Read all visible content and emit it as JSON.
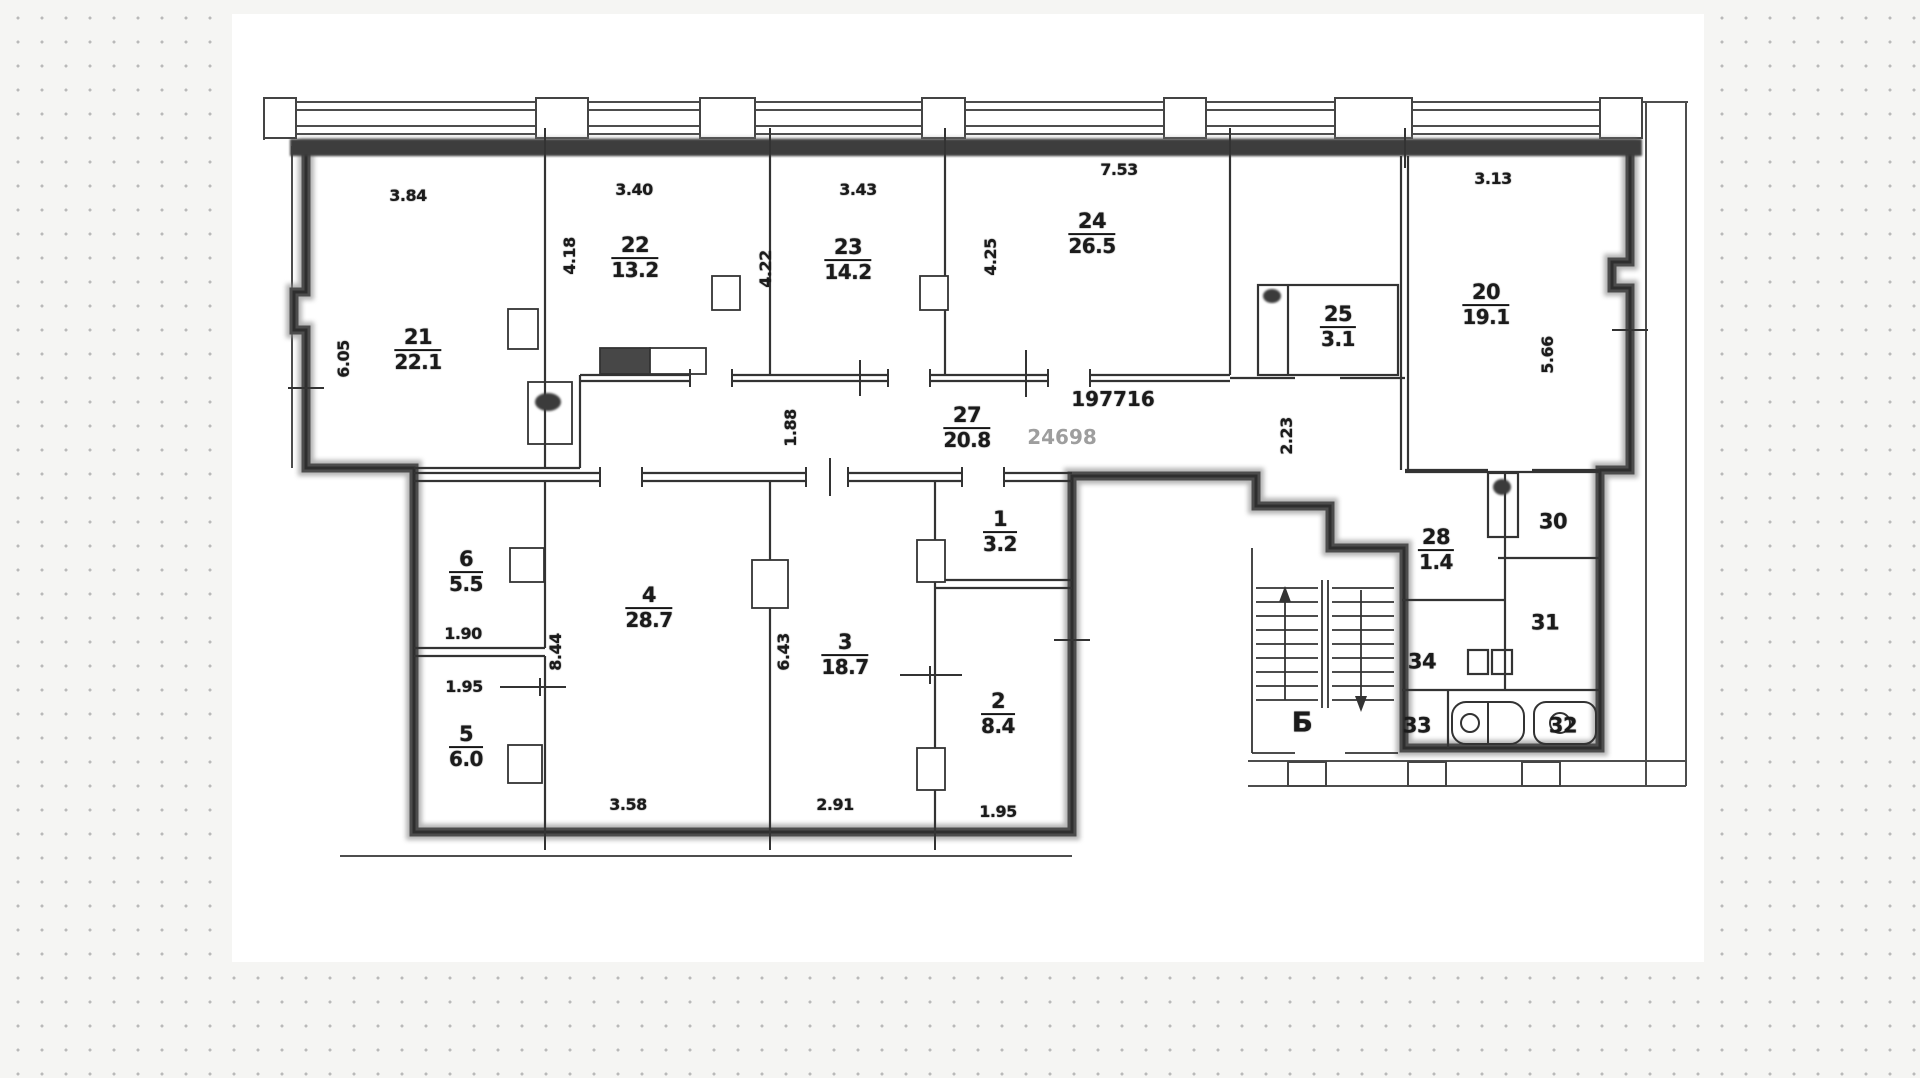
{
  "plan": {
    "stamp_black": "197716",
    "stamp_gray": "24698",
    "stair_label": "Б",
    "rooms": {
      "r21": {
        "n": "21",
        "a": "22.1"
      },
      "r22": {
        "n": "22",
        "a": "13.2"
      },
      "r23": {
        "n": "23",
        "a": "14.2"
      },
      "r24": {
        "n": "24",
        "a": "26.5"
      },
      "r25": {
        "n": "25",
        "a": "3.1"
      },
      "r20": {
        "n": "20",
        "a": "19.1"
      },
      "r27": {
        "n": "27",
        "a": "20.8"
      },
      "r1": {
        "n": "1",
        "a": "3.2"
      },
      "r2": {
        "n": "2",
        "a": "8.4"
      },
      "r3": {
        "n": "3",
        "a": "18.7"
      },
      "r4": {
        "n": "4",
        "a": "28.7"
      },
      "r5": {
        "n": "5",
        "a": "6.0"
      },
      "r6": {
        "n": "6",
        "a": "5.5"
      },
      "r28": {
        "n": "28",
        "a": "1.4"
      }
    },
    "numbers_only": {
      "r30": "30",
      "r31": "31",
      "r34": "34",
      "r33": "33",
      "r32": "32"
    },
    "dims": {
      "w21": "3.84",
      "w22": "3.40",
      "w23": "3.43",
      "w24": "7.53",
      "w20": "3.13",
      "h21": "6.05",
      "h22": "4.18",
      "h23": "4.22",
      "h24": "4.25",
      "h20": "5.66",
      "h27": "1.88",
      "hstub": "2.23",
      "h4": "8.44",
      "h3": "6.43",
      "w6": "1.90",
      "w5": "1.95",
      "w4": "3.58",
      "w3": "2.91",
      "w2": "1.95"
    }
  }
}
